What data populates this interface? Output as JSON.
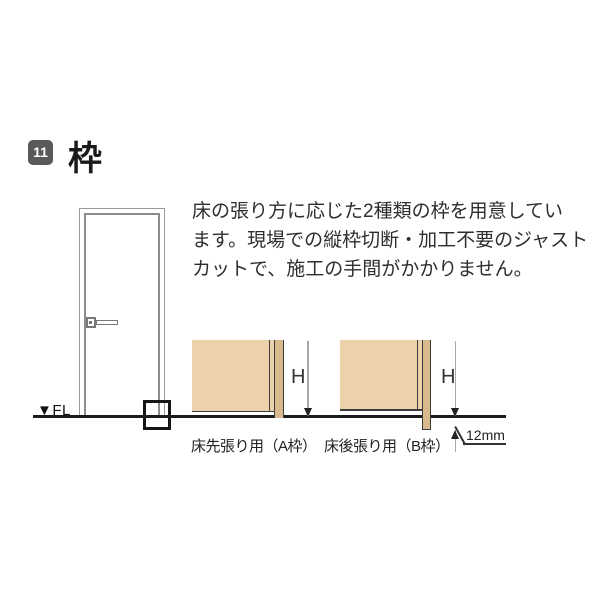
{
  "page": {
    "section": {
      "number": "11",
      "title": "枠"
    },
    "description": {
      "lines": [
        "床の張り方に応じた2種類の枠を用意してい",
        "ます。現場での縦枠切断・加工不要のジャスト",
        "カットで、施工の手間がかかりません。"
      ]
    },
    "door_drawing": {
      "floor_label": "▼FL"
    },
    "frame_diagrams": {
      "a": {
        "caption": "床先張り用（A枠）",
        "height_label": "H"
      },
      "b": {
        "caption": "床後張り用（B枠）",
        "height_label": "H",
        "offset_label": "12mm"
      }
    },
    "colors": {
      "badge_background": "#58595b",
      "wall_fill": "#ebd2ab",
      "frame_fill": "#d9ba8f",
      "floor_line": "#1c1c1c",
      "door_outline": "#9b9b9b",
      "outline_dark": "#3c3c3c",
      "text": "#2e2e2e"
    }
  }
}
